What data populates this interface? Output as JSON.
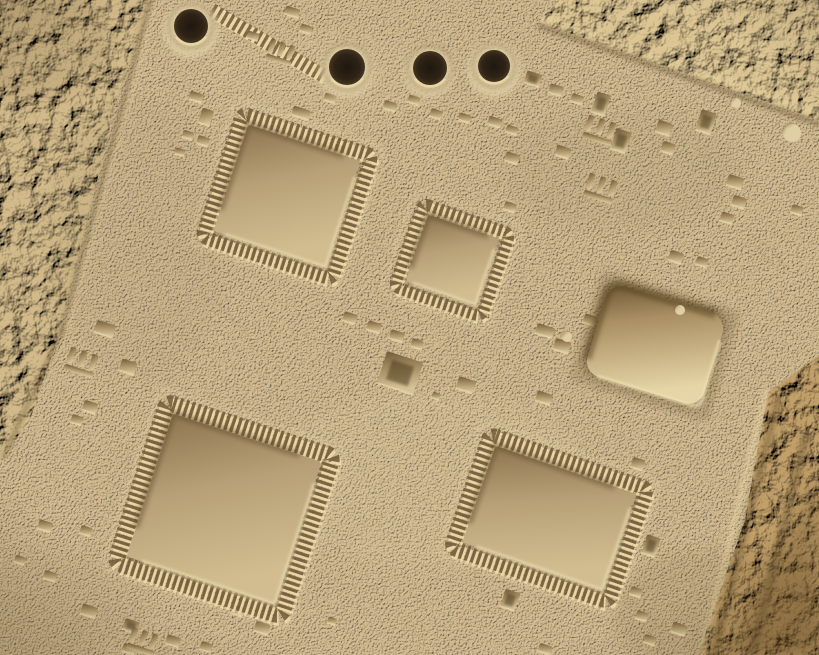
{
  "photo": {
    "description": "Macro photograph of a sand-dust covered printed circuit board: four dark drill holes along the top, four square QFP chip imprints with pin fringes, one smooth square socket depression, scattered small component footprints, rough coarse sand bands in the top-left, top-right and bottom-right corners."
  },
  "scene": {
    "width": 819,
    "height": 655,
    "angle": 18,
    "palette": {
      "sand": "#d3bc92",
      "sand_light": "#e0cfa4",
      "sand_dark": "#a98f66",
      "highlight": "#efe1b4",
      "shadow": "#86704c",
      "groove_dark": "#64502f",
      "groove_light": "#ecdaa8",
      "pin_dark": "#6e5838",
      "pin_light": "#eedcaa",
      "imp_dark": "#6b563a",
      "imp_mid": "#9d8459",
      "imp_light": "#d6c397",
      "imp_deep": "#3f3018",
      "chip_dark": "#8d7550",
      "chip_mid": "#b7a077",
      "chip_light": "#d2bd90",
      "chip3_dark": "#6d5535",
      "chip3_mid": "#a98f63",
      "chip3_light": "#e6d5a6",
      "hole_core": "#1f1710",
      "hole_mid": "#2e2315",
      "hole_edge": "#453524",
      "rough_left": "#d2ba8a",
      "rough_topright": "#ddc694",
      "rough_bottomright": "#c2a06a",
      "amber_dark": "#7e6136",
      "vignette": "#3b2810"
    },
    "bands": [
      {
        "name": "rough-left",
        "points": "0,0 152,0 118,95 60,332 30,420 0,460",
        "fill": "#d2ba8a",
        "filter": "frough"
      },
      {
        "name": "rough-topright",
        "points": "538,22 560,0 819,0 819,120",
        "fill": "#ddc694",
        "filter": "frough"
      },
      {
        "name": "rough-bottomright",
        "points": "768,392 819,356 819,655 698,655 745,520",
        "fill": "#c2a06a",
        "filter": "famber"
      }
    ],
    "corner_shade": {
      "points": "819,470 819,655 728,655",
      "fill": "#7e6136",
      "opacity": 0.4
    },
    "grooves": [
      {
        "x1": 150,
        "y1": 2,
        "x2": 62,
        "y2": 330,
        "t": "d",
        "w": 5
      },
      {
        "x1": 62,
        "y1": 330,
        "x2": 4,
        "y2": 456,
        "t": "d",
        "w": 5
      },
      {
        "x1": 155,
        "y1": 6,
        "x2": 67,
        "y2": 331,
        "t": "l",
        "w": 2
      },
      {
        "x1": 540,
        "y1": 26,
        "x2": 819,
        "y2": 124,
        "t": "d",
        "w": 6
      },
      {
        "x1": 545,
        "y1": 18,
        "x2": 819,
        "y2": 113,
        "t": "l",
        "w": 3
      },
      {
        "x1": 766,
        "y1": 392,
        "x2": 702,
        "y2": 652,
        "t": "l",
        "w": 5
      },
      {
        "x1": 778,
        "y1": 400,
        "x2": 714,
        "y2": 655,
        "t": "d",
        "w": 7
      },
      {
        "x1": 806,
        "y1": 436,
        "x2": 752,
        "y2": 655,
        "t": "d",
        "w": 9
      }
    ],
    "blobs": [
      {
        "cx": 620,
        "cy": 170,
        "rx": 120,
        "ry": 60,
        "c": "#8d7a58",
        "o": 0.1
      },
      {
        "cx": 140,
        "cy": 240,
        "rx": 90,
        "ry": 140,
        "c": "#8d7a58",
        "o": 0.08
      },
      {
        "cx": 430,
        "cy": 480,
        "rx": 160,
        "ry": 90,
        "c": "#efe0b2",
        "o": 0.1
      },
      {
        "cx": 320,
        "cy": 80,
        "rx": 120,
        "ry": 50,
        "c": "#efe0b2",
        "o": 0.08
      },
      {
        "cx": 720,
        "cy": 610,
        "rx": 110,
        "ry": 60,
        "c": "#6b4f28",
        "o": 0.12
      },
      {
        "cx": 60,
        "cy": 600,
        "rx": 90,
        "ry": 50,
        "c": "#8d7a58",
        "o": 0.08
      },
      {
        "cx": 30,
        "cy": 40,
        "rx": 80,
        "ry": 60,
        "c": "#6b5436",
        "o": 0.12
      }
    ],
    "strips": [
      [
        212,
        10,
        324,
        76,
        14
      ]
    ],
    "holes": [
      {
        "cx": 191,
        "cy": 26,
        "r": 17,
        "mound": 28
      },
      {
        "cx": 347,
        "cy": 67,
        "r": 18,
        "mound": 27
      },
      {
        "cx": 430,
        "cy": 68,
        "r": 17,
        "mound": 25
      },
      {
        "cx": 494,
        "cy": 66,
        "r": 16,
        "mound": 27
      }
    ],
    "chips": [
      {
        "cx": 287,
        "cy": 196,
        "w": 118,
        "h": 112,
        "a": 18,
        "pins": true,
        "pw": 14
      },
      {
        "cx": 452,
        "cy": 260,
        "w": 74,
        "h": 70,
        "a": 19,
        "pins": true,
        "pw": 12
      },
      {
        "cx": 224,
        "cy": 509,
        "w": 156,
        "h": 150,
        "a": 18,
        "pins": true,
        "pw": 17
      },
      {
        "cx": 549,
        "cy": 518,
        "w": 148,
        "h": 102,
        "a": 19,
        "pins": true,
        "pw": 15
      },
      {
        "cx": 655,
        "cy": 345,
        "w": 122,
        "h": 94,
        "a": 17,
        "pins": false
      }
    ],
    "imprints": [
      [
        196,
        97,
        14,
        9
      ],
      [
        206,
        117,
        12,
        16
      ],
      [
        188,
        135,
        11,
        8
      ],
      [
        203,
        141,
        12,
        9
      ],
      [
        180,
        152,
        10,
        7
      ],
      [
        253,
        36,
        12,
        8
      ],
      [
        292,
        12,
        15,
        9
      ],
      [
        306,
        29,
        12,
        8
      ],
      [
        301,
        113,
        18,
        10
      ],
      [
        330,
        98,
        12,
        8
      ],
      [
        340,
        150,
        14,
        9
      ],
      [
        390,
        106,
        13,
        9
      ],
      [
        414,
        100,
        12,
        8
      ],
      [
        436,
        114,
        12,
        9
      ],
      [
        465,
        118,
        12,
        8
      ],
      [
        495,
        122,
        14,
        9
      ],
      [
        512,
        130,
        12,
        8
      ],
      [
        533,
        79,
        16,
        13,
        1
      ],
      [
        556,
        90,
        14,
        10
      ],
      [
        577,
        99,
        12,
        9
      ],
      [
        601,
        104,
        14,
        22,
        1
      ],
      [
        621,
        141,
        16,
        22,
        1
      ],
      [
        664,
        128,
        15,
        13
      ],
      [
        668,
        148,
        13,
        11
      ],
      [
        706,
        122,
        16,
        22,
        1
      ],
      [
        563,
        152,
        15,
        11
      ],
      [
        512,
        158,
        14,
        10
      ],
      [
        510,
        207,
        12,
        9
      ],
      [
        735,
        182,
        16,
        12
      ],
      [
        739,
        202,
        14,
        11
      ],
      [
        727,
        218,
        13,
        10
      ],
      [
        676,
        257,
        14,
        11
      ],
      [
        702,
        262,
        12,
        9
      ],
      [
        797,
        210,
        12,
        9
      ],
      [
        350,
        318,
        14,
        10
      ],
      [
        374,
        327,
        14,
        10
      ],
      [
        397,
        336,
        14,
        10
      ],
      [
        417,
        344,
        12,
        9
      ],
      [
        400,
        373,
        38,
        34,
        1
      ],
      [
        466,
        385,
        18,
        13
      ],
      [
        545,
        331,
        18,
        11
      ],
      [
        562,
        346,
        16,
        12
      ],
      [
        590,
        320,
        13,
        10
      ],
      [
        544,
        398,
        16,
        11
      ],
      [
        436,
        396,
        8,
        7
      ],
      [
        105,
        329,
        20,
        13
      ],
      [
        128,
        367,
        16,
        13
      ],
      [
        90,
        407,
        14,
        11
      ],
      [
        77,
        420,
        12,
        9
      ],
      [
        20,
        560,
        11,
        8
      ],
      [
        50,
        576,
        13,
        9
      ],
      [
        190,
        586,
        18,
        13
      ],
      [
        247,
        594,
        16,
        12
      ],
      [
        262,
        628,
        15,
        11
      ],
      [
        45,
        526,
        14,
        10
      ],
      [
        86,
        531,
        12,
        9
      ],
      [
        286,
        531,
        11,
        8
      ],
      [
        89,
        611,
        16,
        11
      ],
      [
        131,
        626,
        15,
        12,
        1
      ],
      [
        129,
        649,
        13,
        9
      ],
      [
        173,
        641,
        14,
        10
      ],
      [
        206,
        647,
        12,
        9
      ],
      [
        238,
        611,
        12,
        9
      ],
      [
        332,
        621,
        9,
        7
      ],
      [
        510,
        600,
        15,
        19,
        1
      ],
      [
        545,
        649,
        13,
        9
      ],
      [
        638,
        464,
        13,
        11
      ],
      [
        651,
        546,
        14,
        20,
        1
      ],
      [
        636,
        592,
        12,
        9
      ],
      [
        642,
        616,
        12,
        9
      ],
      [
        650,
        640,
        12,
        9
      ],
      [
        679,
        629,
        15,
        11
      ],
      [
        622,
        484,
        10,
        8
      ],
      [
        620,
        500,
        10,
        8
      ],
      [
        618,
        516,
        10,
        8
      ]
    ],
    "combs": [
      [
        281,
        52,
        26
      ],
      [
        600,
        130,
        30
      ],
      [
        601,
        188,
        30
      ],
      [
        82,
        362,
        30
      ],
      [
        143,
        641,
        28
      ]
    ],
    "pebbles": [
      [
        792,
        133,
        9
      ],
      [
        736,
        103,
        5
      ],
      [
        680,
        310,
        5
      ],
      [
        567,
        337,
        5
      ]
    ],
    "scratches": [
      [
        358,
        228,
        398,
        266
      ],
      [
        215,
        300,
        250,
        338
      ],
      [
        752,
        243,
        780,
        272
      ],
      [
        760,
        240,
        788,
        268
      ],
      [
        300,
        470,
        260,
        510
      ]
    ]
  }
}
